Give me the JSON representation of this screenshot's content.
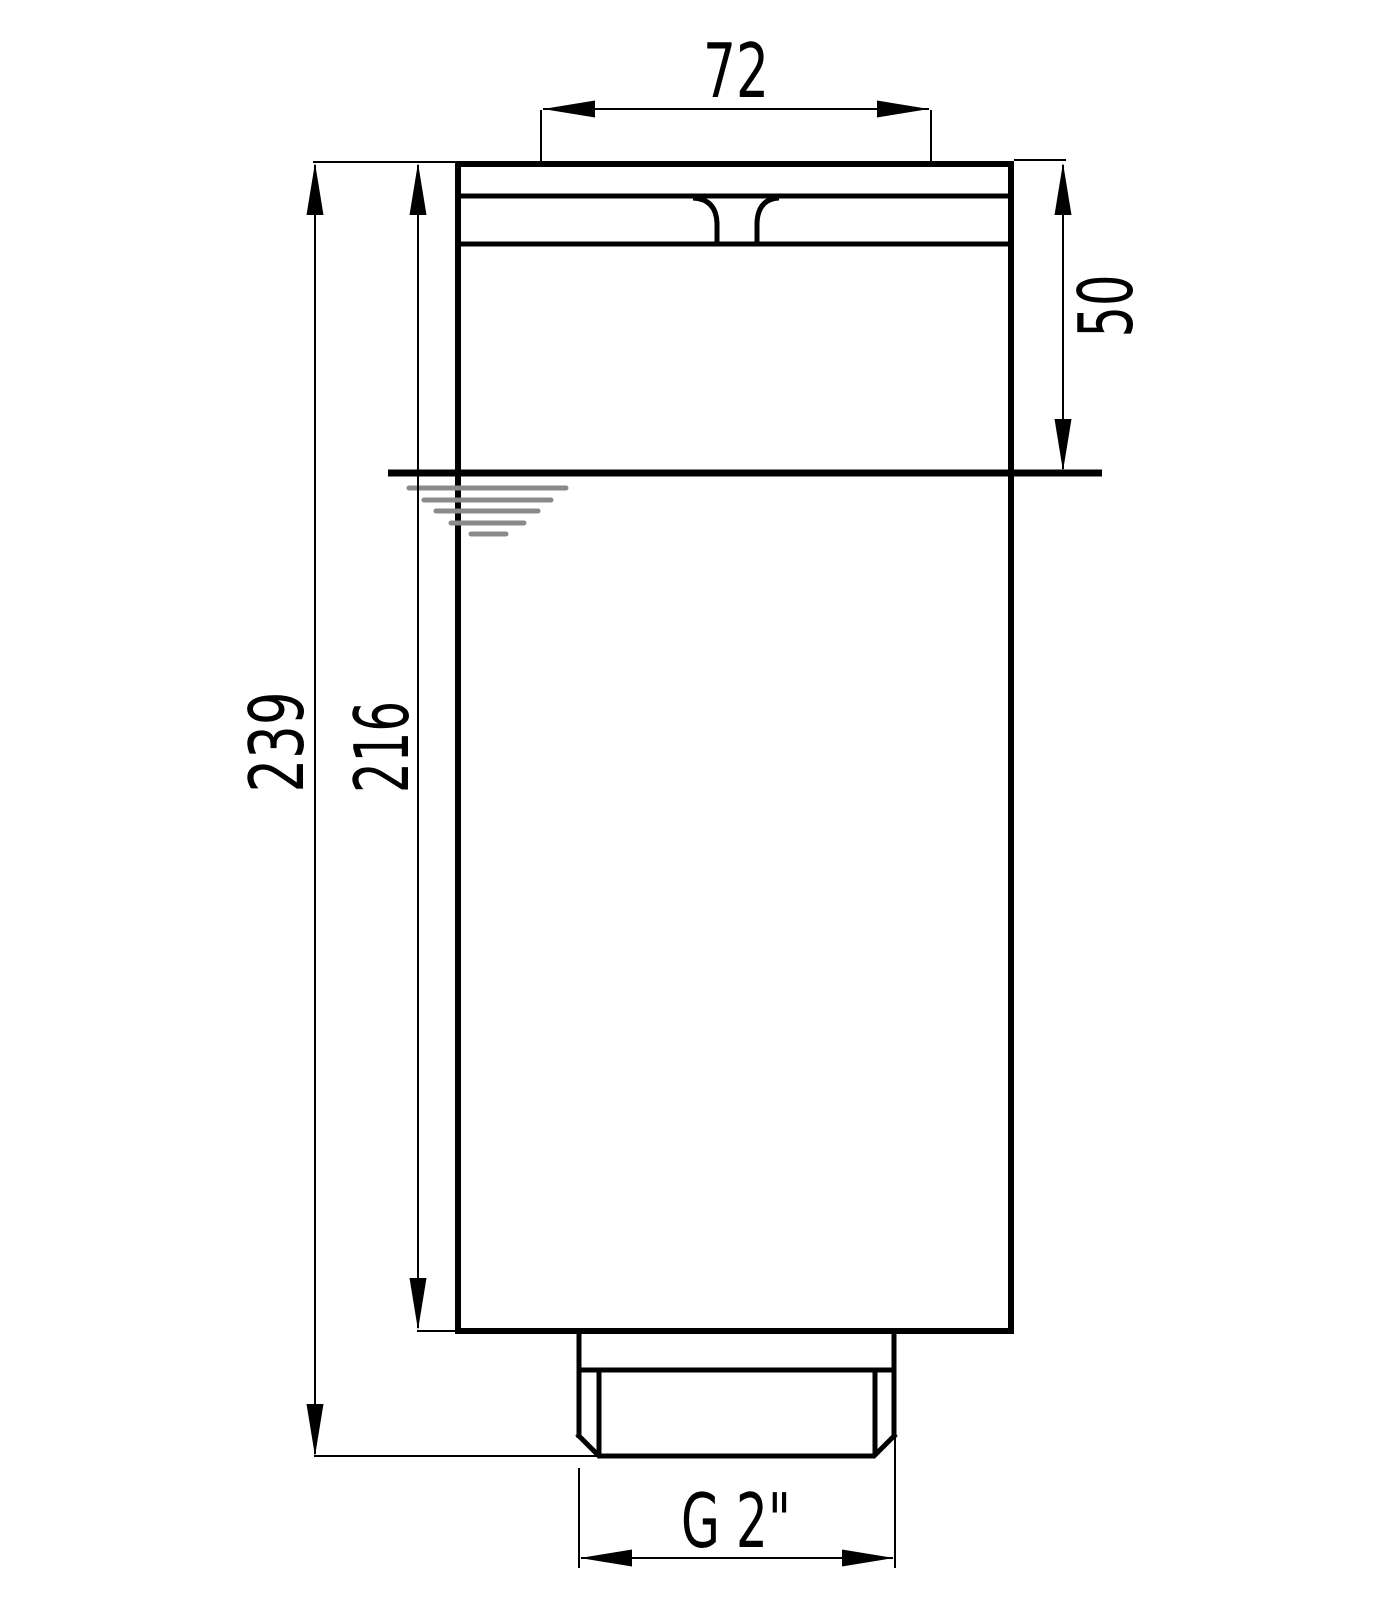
{
  "drawing": {
    "kind": "technical-dimension-drawing",
    "view": "front-elevation",
    "subject": "cylindrical vessel with top cap, liquid level mark and threaded bottom spigot"
  },
  "dimensions": {
    "top_width": {
      "value": "72",
      "orientation": "horizontal",
      "location": "top"
    },
    "cap_depth": {
      "value": "50",
      "orientation": "vertical",
      "location": "right"
    },
    "overall_height": {
      "value": "239",
      "orientation": "vertical",
      "location": "left-outer"
    },
    "body_height": {
      "value": "216",
      "orientation": "vertical",
      "location": "left-inner"
    },
    "thread_size": {
      "value": "G 2\"",
      "orientation": "horizontal",
      "location": "bottom"
    }
  },
  "symbols": {
    "water_level": {
      "name": "liquid-level-symbol",
      "bar_count": 5
    }
  },
  "colors": {
    "line": "#000000",
    "water_symbol": "#8a8a8a",
    "background": "#ffffff"
  }
}
